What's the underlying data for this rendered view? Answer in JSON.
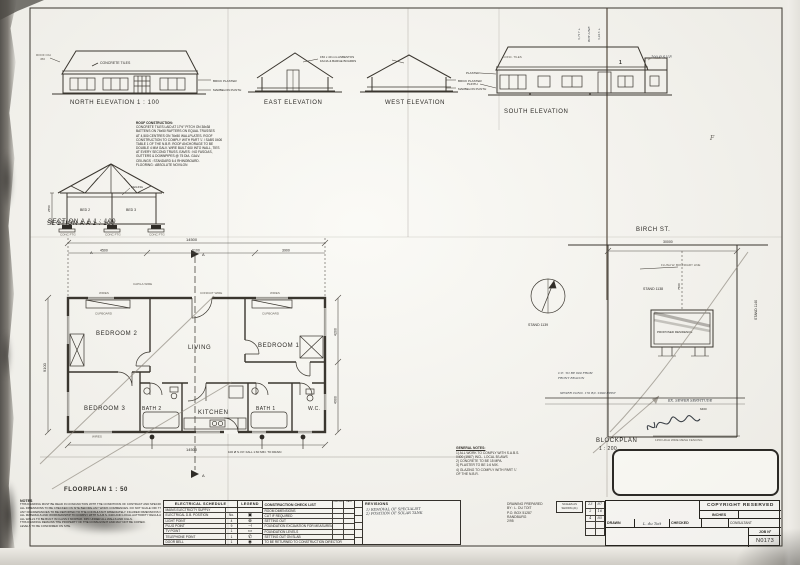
{
  "elevations": {
    "north": {
      "label": "NORTH ELEVATION 1 : 100",
      "tiles": "CONCRETE TILES",
      "roof_oh1": "ROOF O/H",
      "roof_oh2": "450",
      "plaster": "BRICK PLASTER",
      "plinth": "MARBELON PLINTH"
    },
    "east": {
      "label": "EAST ELEVATION"
    },
    "west": {
      "label": "WEST ELEVATION",
      "plaster": "BRICK PLASTER",
      "plinth": "MARBELON PLINTH"
    },
    "south": {
      "label": "SOUTH ELEVATION",
      "tiles": "CONC. TILES",
      "plaster": "PLASTER",
      "plinth": "PLINTH",
      "svp": "100 Ø S.V.P.",
      "mark": "1",
      "lvl1": "5,717 +",
      "lvl2": "BDY LINE",
      "lvl3": "5,615 +",
      "mark_f": "F"
    },
    "fascia1": "150 x 40 mm ASBESTOS",
    "fascia2": "FACIA & BARGE BOARDS"
  },
  "roof_note": {
    "title": "ROOF CONSTRUCTION:",
    "lines": [
      "CONCRETE TILES LAID AT 17½° PITCH ON 38x38",
      "BATTENS ON 76x50 RAFTERS ON EQUAL TRUSSES",
      "AT 4,500 CENTRES ON 76x50 WALLPLATES. ROOF",
      "CONSTRUCTION TO COMPLY WITH PART 'L' / SABS 0400",
      "TABLE 1 OF THE N.B.R. ROOF ANCHORAGE TO BE",
      "DOUBLE 4 MM GALV. WIRE BUILT 600 INTO WALL, TIES",
      "AT EVERY SECOND TRUSS. EAVES : NO FASCIAS,",
      "GUTTERS & DOWNPIPES @ 75 DIA. GALV.",
      "CEILINGS : STANDARD 6.4 RHINOBOARD.",
      "FLOORING :  ABSOLUTE NOVILON"
    ]
  },
  "section": {
    "label": "SECTION A A 1 : 100",
    "room1": "BED 2",
    "room2": "BED 3",
    "ceiling": "CEILING",
    "height": "2550",
    "ftg": "CONC FTG"
  },
  "floorplan": {
    "label": "FLOORPLAN   1 : 50",
    "rooms": {
      "bedroom2": "BEDROOM 2",
      "living": "LIVING",
      "bedroom1": "BEDROOM 1",
      "bedroom3": "BEDROOM 3",
      "bath2": "BATH 2",
      "kitchen": "KITCHEN",
      "bath1": "BATH 1",
      "wc": "W.C."
    },
    "cupboard": "CUPBOARD",
    "wires": "WIRES",
    "capila": "CAPILA WIRE",
    "conduit": "CONDUIT WIRE",
    "svp_note": "100 Ø S.V.P. FALL 1:60 MIN. TO DRAIN",
    "marker_a": "A",
    "dims": {
      "overall_top": "14500",
      "seg1": "4500",
      "seg2": "6100",
      "seg3": "3900",
      "left": "9100",
      "right1": "4200",
      "right2": "4900",
      "overall_bottom": "14500"
    }
  },
  "blockplan": {
    "label1": "BLOCKPLAN",
    "label2": "1 : 200",
    "street": "BIRCH ST.",
    "dim_top": "30000",
    "dim_side": "7500",
    "dim_small": "6460",
    "stand_left": "STAND 1139",
    "stand_centre": "STAND 1138",
    "stand_right": "STAND 1140",
    "building": "PROPOSED RESIDENCE",
    "flush": "FLUSH W. BOUNDARY LINE",
    "note_ce1": "C.E. TO BE 600 FROM",
    "note_ce2": "FRONT  BEACON",
    "note_sewer": "SEWER CONN. 170 R/L  ±800 DEEP",
    "servitude": "EX. SEWER SERVITUDE",
    "fence": "1350 HIGH WIRE MESH FENCING"
  },
  "general_notes": {
    "title": "GENERAL NOTES:",
    "lines": [
      "1) ALL WORK TO COMPLY WITH S.A.B.S.",
      "     0400 (1987) INCL. LOCAL B'LAWS",
      "2) CONCRETE TO BE 15 MPA.",
      "3) PLASTER TO BE 1:6 MIX.",
      "4) GLAZING TO COMPLY WITH PART 'L'",
      "     OF THE N.B.R."
    ]
  },
  "notes_panel": {
    "title": "NOTES",
    "lines": [
      "THIS DRAWING MUST BE READ IN CONJUNCTION WITH THE CONDITIONS OF CONTRACT AND SPECIFICATIONS.",
      "ALL DIMENSIONS TO BE CHECKED ON SITE BEFORE ANY WORK COMMENCES. DO NOT SCALE OFF THIS DRAWING.",
      "ANY DISCREPANCIES TO BE REPORTED TO THE CONSULTANT IMMEDIATELY. FIGURED DIMENSIONS ONLY.",
      "ALL MATERIALS AND WORKMANSHIP TO COMPLY WITH S.A.B.S. 0400 AND LOCAL AUTHORITY REGULATIONS.",
      "ALL WALLS TO BE BUILT IN CLASS II MORTAR. DPC UNDER ALL WALLS AND CILLS.",
      "THIS DRAWING REMAINS THE PROPERTY OF THE CONSULTANT AND MAY NOT BE COPIED.",
      "LEVELS TO BE CONFIRMED ON SITE."
    ]
  },
  "electrical": {
    "title": "ELECTRICAL  SCHEDULE",
    "rows": [
      {
        "item": "MAINS ELECTRICITY SUPPLY",
        "qty": ""
      },
      {
        "item": "ELECTRICAL D.B. POSITION",
        "qty": "No."
      },
      {
        "item": "LIGHT POINT",
        "qty": "4"
      },
      {
        "item": "PLUG POINT",
        "qty": "9"
      },
      {
        "item": "TV POINT",
        "qty": "1"
      },
      {
        "item": "TELEPHONE POINT",
        "qty": "1"
      },
      {
        "item": "DOOR BELL",
        "qty": "1"
      }
    ]
  },
  "legend": {
    "title": "LEGEND",
    "symbols": [
      "",
      "▣",
      "⊗",
      "⊣",
      "▭",
      "✆",
      "◉"
    ]
  },
  "checklist": {
    "title": "CONSTRUCTION CHECK LIST",
    "col1": "CHECKED",
    "col2": "DATE",
    "rows": [
      "ROOM DIMENSIONS",
      "CUT IF REQUIRED",
      "SETTING OUT",
      "FOUNDATION EXCAVATION FOR MEASUREMENT",
      "FOUNDATION LEVELS",
      "SETTING OUT ON SLAB"
    ],
    "footer": "TO BE RETURNED TO CONSTRUCTION DIRECTOR"
  },
  "revisions": {
    "title": "REVISIONS",
    "entries": [
      "1) REMOVAL OF SPECIALIST",
      "2) POSITION OF SOLAR TANK"
    ]
  },
  "prepared": {
    "lines": [
      "DRAWING PREPARED",
      "BY : L. DU TOIT",
      "P.O. BOX 51287",
      "RANDBURG",
      "2/95"
    ]
  },
  "scales": {
    "line1": "SCALES AS",
    "line2": "SHOWN (A1)"
  },
  "dates": {
    "rows": [
      [
        "23",
        "87"
      ],
      [
        "2",
        "16"
      ],
      [
        "4",
        "85"
      ],
      [
        "",
        ""
      ],
      [
        "",
        ""
      ]
    ]
  },
  "titleblock": {
    "copyright": "COPYRIGHT RESERVED",
    "inches": "INCHES",
    "drawn": "DRAWN",
    "drawn_value": "L. du Toit",
    "checked": "CHECKED",
    "consultant": "CONSULTANT",
    "job_label": "JOB Nº",
    "job_value": "N0173"
  }
}
